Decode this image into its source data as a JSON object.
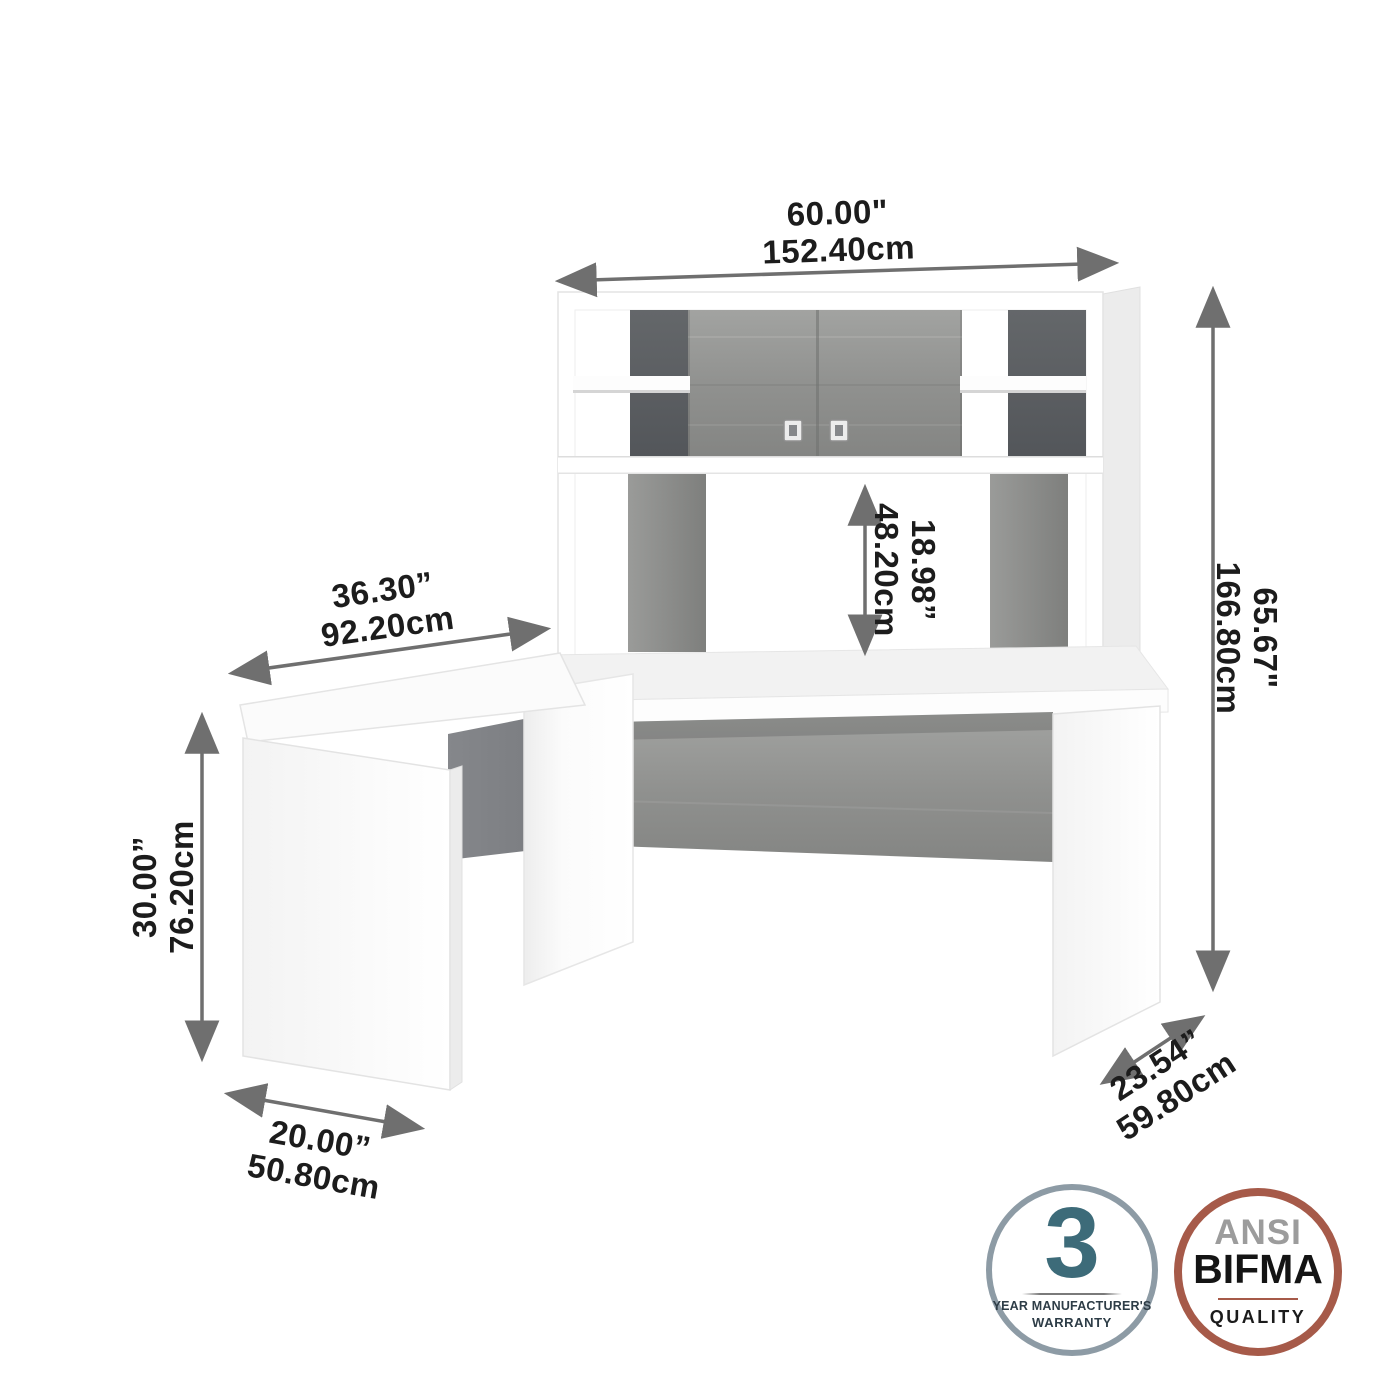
{
  "dimensions": {
    "width": {
      "inches": "60.00\"",
      "cm": "152.40cm"
    },
    "height": {
      "inches": "65.67\"",
      "cm": "166.80cm"
    },
    "opening": {
      "inches": "18.98”",
      "cm": "48.20cm"
    },
    "return_length": {
      "inches": "36.30”",
      "cm": "92.20cm"
    },
    "desk_height": {
      "inches": "30.00”",
      "cm": "76.20cm"
    },
    "return_width": {
      "inches": "20.00”",
      "cm": "50.80cm"
    },
    "desk_depth": {
      "inches": "23.54”",
      "cm": "59.80cm"
    }
  },
  "badges": {
    "warranty": {
      "number": "3",
      "line1": "YEAR MANUFACTURER'S",
      "line2": "WARRANTY",
      "ring_color": "#8d9ba5",
      "number_color": "#3d6b79"
    },
    "ansi": {
      "line1": "ANSI",
      "line2": "BIFMA",
      "line3": "QUALITY",
      "ring_color": "#a65a49",
      "ansi_text_color": "#9c9c9c"
    }
  },
  "colors": {
    "wood_light": "#8f908e",
    "wood_dark": "#5b5e60",
    "arrow": "#6f6f6f",
    "text": "#1c1c1c",
    "background": "#ffffff"
  }
}
